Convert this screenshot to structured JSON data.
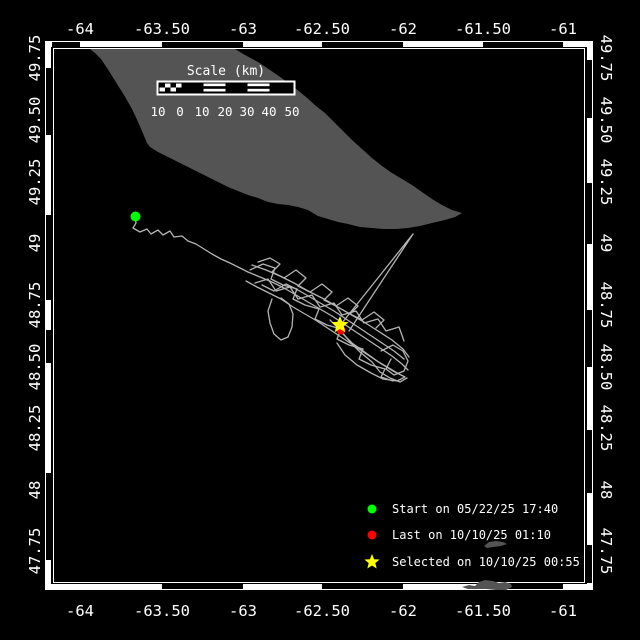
{
  "map_frame": {
    "bg": "#000000",
    "frame_color": "#ffffff",
    "land_color": "#545454",
    "track_color": "#b4b4b4",
    "text_color": "#ffffff",
    "inner_rect": [
      53.5,
      48.5,
      531,
      534
    ],
    "band_thickness": 6,
    "outer": [
      45,
      41,
      548,
      549
    ],
    "dashes": {
      "top": [
        [
          52,
          80
        ],
        [
          162,
          243
        ],
        [
          322,
          403
        ],
        [
          483,
          563
        ]
      ],
      "bottom": [
        [
          162,
          243
        ],
        [
          322,
          403
        ],
        [
          483,
          563
        ]
      ],
      "left": [
        [
          68,
          135
        ],
        [
          215,
          300
        ],
        [
          330,
          363
        ],
        [
          473,
          560
        ]
      ],
      "right": [
        [
          60,
          118
        ],
        [
          183,
          244
        ],
        [
          310,
          367
        ],
        [
          430,
          493
        ],
        [
          545,
          583
        ]
      ]
    }
  },
  "axes": {
    "lon": {
      "labels": [
        "-64",
        "-63.50",
        "-63",
        "-62.50",
        "-62",
        "-61.50",
        "-61"
      ],
      "x": [
        80,
        162,
        243,
        322,
        403,
        483,
        563
      ],
      "top_y": 29,
      "bottom_y": 611
    },
    "lat": {
      "labels": [
        "49.75",
        "49.50",
        "49.25",
        "49",
        "48.75",
        "48.50",
        "48.25",
        "48",
        "47.75"
      ],
      "y": [
        58,
        120,
        182,
        243,
        305,
        367,
        428,
        490,
        551
      ],
      "left_x": 35,
      "right_x": 606
    }
  },
  "scale_bar": {
    "title": "Scale (km)",
    "title_x": 226,
    "title_y": 75,
    "labels": [
      "10",
      "0",
      "10",
      "20",
      "30",
      "40",
      "50"
    ],
    "label_x": [
      158,
      180,
      202,
      225,
      247,
      269,
      292
    ],
    "label_y": 116,
    "bar": [
      157,
      81,
      137,
      13
    ],
    "segments": [
      "check",
      "solid",
      "stripe",
      "solid",
      "stripe",
      "solid"
    ]
  },
  "legend": {
    "items": [
      {
        "label": "Start on 05/22/25 17:40",
        "marker": "circle",
        "color": "#00ff00"
      },
      {
        "label": "Last on 10/10/25 01:10",
        "marker": "circle",
        "color": "#ff0000"
      },
      {
        "label": "Selected on 10/10/25 00:55",
        "marker": "star",
        "color": "#ffff00"
      }
    ],
    "marker_x": 372,
    "text_x": 392,
    "row_y": [
      509,
      535,
      562
    ]
  },
  "markers": {
    "start": {
      "x": 135.5,
      "y": 216.5,
      "r": 5,
      "color": "#00ff00"
    },
    "last": {
      "x": 341,
      "y": 330,
      "r": 4.5,
      "color": "#ff0000"
    },
    "selected": {
      "x": 340,
      "y": 325,
      "R": 9,
      "r": 4,
      "color": "#ffff00"
    }
  },
  "geometry": {
    "island": [
      [
        90,
        49
      ],
      [
        235,
        49
      ],
      [
        245,
        55
      ],
      [
        258,
        62
      ],
      [
        270,
        70
      ],
      [
        283,
        79
      ],
      [
        295,
        88
      ],
      [
        306,
        97
      ],
      [
        316,
        106
      ],
      [
        325,
        113
      ],
      [
        334,
        122
      ],
      [
        343,
        131
      ],
      [
        352,
        140
      ],
      [
        362,
        149
      ],
      [
        372,
        158
      ],
      [
        382,
        166
      ],
      [
        392,
        173
      ],
      [
        402,
        179
      ],
      [
        412,
        185
      ],
      [
        422,
        192
      ],
      [
        432,
        199
      ],
      [
        442,
        205
      ],
      [
        452,
        210
      ],
      [
        462,
        213
      ],
      [
        455,
        217
      ],
      [
        445,
        220
      ],
      [
        432,
        223
      ],
      [
        420,
        226
      ],
      [
        408,
        228
      ],
      [
        396,
        229
      ],
      [
        384,
        229
      ],
      [
        372,
        228
      ],
      [
        360,
        227
      ],
      [
        348,
        224
      ],
      [
        338,
        222
      ],
      [
        328,
        219
      ],
      [
        318,
        216
      ],
      [
        308,
        210
      ],
      [
        298,
        207
      ],
      [
        288,
        205
      ],
      [
        278,
        204
      ],
      [
        268,
        202
      ],
      [
        258,
        198
      ],
      [
        248,
        195
      ],
      [
        238,
        191
      ],
      [
        228,
        187
      ],
      [
        218,
        182
      ],
      [
        208,
        177
      ],
      [
        198,
        172
      ],
      [
        188,
        167
      ],
      [
        178,
        162
      ],
      [
        168,
        157
      ],
      [
        158,
        152
      ],
      [
        150,
        147
      ],
      [
        147,
        143
      ],
      [
        144,
        136
      ],
      [
        139,
        124
      ],
      [
        132,
        109
      ],
      [
        124,
        95
      ],
      [
        117,
        84
      ],
      [
        109,
        71
      ],
      [
        101,
        59
      ],
      [
        95,
        53
      ]
    ],
    "islet_a": [
      [
        484,
        546
      ],
      [
        489,
        542
      ],
      [
        496,
        541
      ],
      [
        503,
        542
      ],
      [
        507,
        544
      ],
      [
        501,
        546
      ],
      [
        493,
        547
      ],
      [
        487,
        548
      ]
    ],
    "islet_b": [
      [
        462,
        587
      ],
      [
        469,
        585
      ],
      [
        475,
        586
      ],
      [
        479,
        582
      ],
      [
        485,
        580
      ],
      [
        493,
        581
      ],
      [
        499,
        583
      ],
      [
        505,
        582
      ],
      [
        511,
        584
      ],
      [
        512,
        587
      ],
      [
        506,
        590
      ],
      [
        496,
        590
      ],
      [
        486,
        589
      ],
      [
        476,
        589
      ],
      [
        468,
        589
      ]
    ],
    "track_tail": [
      [
        135,
        216
      ],
      [
        136,
        223
      ],
      [
        133,
        228
      ],
      [
        140,
        232
      ],
      [
        147,
        229
      ],
      [
        151,
        234
      ],
      [
        158,
        230
      ],
      [
        163,
        235
      ],
      [
        170,
        231
      ],
      [
        174,
        237
      ],
      [
        182,
        236
      ],
      [
        188,
        241
      ],
      [
        196,
        244
      ],
      [
        204,
        249
      ],
      [
        212,
        254
      ],
      [
        221,
        259
      ],
      [
        230,
        263
      ],
      [
        240,
        268
      ],
      [
        248,
        272
      ]
    ],
    "track_cluster": [
      [
        [
          248,
          272
        ],
        [
          260,
          277
        ],
        [
          272,
          282
        ],
        [
          284,
          288
        ],
        [
          296,
          295
        ],
        [
          308,
          302
        ],
        [
          320,
          309
        ],
        [
          332,
          316
        ],
        [
          344,
          324
        ],
        [
          356,
          332
        ],
        [
          368,
          340
        ],
        [
          380,
          348
        ],
        [
          392,
          356
        ],
        [
          402,
          364
        ],
        [
          408,
          370
        ]
      ],
      [
        [
          252,
          265
        ],
        [
          266,
          270
        ],
        [
          280,
          276
        ],
        [
          294,
          283
        ],
        [
          308,
          291
        ],
        [
          322,
          298
        ],
        [
          336,
          306
        ],
        [
          350,
          314
        ],
        [
          364,
          322
        ],
        [
          378,
          331
        ],
        [
          392,
          340
        ],
        [
          403,
          349
        ],
        [
          409,
          357
        ]
      ],
      [
        [
          246,
          281
        ],
        [
          257,
          287
        ],
        [
          269,
          293
        ],
        [
          281,
          299
        ],
        [
          293,
          307
        ],
        [
          305,
          314
        ],
        [
          317,
          321
        ],
        [
          329,
          329
        ],
        [
          341,
          337
        ],
        [
          353,
          345
        ],
        [
          365,
          353
        ],
        [
          377,
          361
        ],
        [
          389,
          368
        ],
        [
          399,
          374
        ]
      ],
      [
        [
          250,
          270
        ],
        [
          263,
          264
        ],
        [
          275,
          268
        ],
        [
          271,
          279
        ],
        [
          283,
          285
        ],
        [
          297,
          289
        ],
        [
          293,
          299
        ],
        [
          305,
          305
        ],
        [
          319,
          309
        ],
        [
          315,
          319
        ],
        [
          327,
          325
        ],
        [
          341,
          329
        ],
        [
          337,
          339
        ],
        [
          349,
          345
        ],
        [
          363,
          349
        ],
        [
          359,
          359
        ],
        [
          371,
          365
        ],
        [
          385,
          369
        ],
        [
          381,
          377
        ],
        [
          393,
          381
        ]
      ],
      [
        [
          255,
          283
        ],
        [
          268,
          279
        ],
        [
          276,
          291
        ],
        [
          290,
          287
        ],
        [
          298,
          299
        ],
        [
          312,
          295
        ],
        [
          320,
          307
        ],
        [
          334,
          303
        ],
        [
          342,
          315
        ],
        [
          356,
          311
        ],
        [
          364,
          323
        ],
        [
          378,
          319
        ],
        [
          386,
          331
        ],
        [
          399,
          327
        ],
        [
          404,
          341
        ]
      ],
      [
        [
          272,
          299
        ],
        [
          268,
          311
        ],
        [
          270,
          323
        ],
        [
          274,
          334
        ],
        [
          281,
          340
        ],
        [
          288,
          337
        ],
        [
          292,
          327
        ],
        [
          293,
          314
        ],
        [
          289,
          304
        ],
        [
          281,
          298
        ]
      ],
      [
        [
          381,
          351
        ],
        [
          393,
          345
        ],
        [
          403,
          351
        ],
        [
          408,
          361
        ],
        [
          404,
          371
        ],
        [
          394,
          375
        ],
        [
          386,
          369
        ],
        [
          391,
          359
        ]
      ],
      [
        [
          340,
          331
        ],
        [
          352,
          343
        ],
        [
          366,
          353
        ],
        [
          380,
          363
        ],
        [
          393,
          371
        ],
        [
          405,
          377
        ],
        [
          397,
          381
        ],
        [
          383,
          379
        ],
        [
          371,
          373
        ],
        [
          357,
          365
        ],
        [
          345,
          355
        ],
        [
          337,
          343
        ]
      ],
      [
        [
          258,
          262
        ],
        [
          270,
          258
        ],
        [
          280,
          264
        ],
        [
          272,
          272
        ],
        [
          284,
          278
        ],
        [
          296,
          270
        ],
        [
          306,
          278
        ],
        [
          298,
          286
        ],
        [
          310,
          292
        ],
        [
          322,
          284
        ],
        [
          332,
          292
        ],
        [
          324,
          300
        ],
        [
          336,
          306
        ],
        [
          348,
          298
        ],
        [
          358,
          306
        ],
        [
          350,
          314
        ],
        [
          362,
          320
        ],
        [
          374,
          312
        ],
        [
          384,
          320
        ],
        [
          376,
          328
        ]
      ],
      [
        [
          262,
          285
        ],
        [
          274,
          291
        ],
        [
          286,
          284
        ],
        [
          298,
          290
        ],
        [
          310,
          297
        ],
        [
          322,
          304
        ],
        [
          334,
          311
        ],
        [
          346,
          319
        ],
        [
          358,
          327
        ],
        [
          370,
          335
        ],
        [
          382,
          343
        ],
        [
          394,
          351
        ],
        [
          404,
          359
        ]
      ],
      [
        [
          330,
          320
        ],
        [
          342,
          332
        ],
        [
          350,
          342
        ],
        [
          360,
          352
        ],
        [
          372,
          362
        ],
        [
          380,
          372
        ],
        [
          390,
          378
        ],
        [
          400,
          382
        ],
        [
          407,
          378
        ]
      ]
    ],
    "excursion": [
      [
        342,
        323
      ],
      [
        413,
        234
      ],
      [
        349,
        331
      ]
    ]
  }
}
